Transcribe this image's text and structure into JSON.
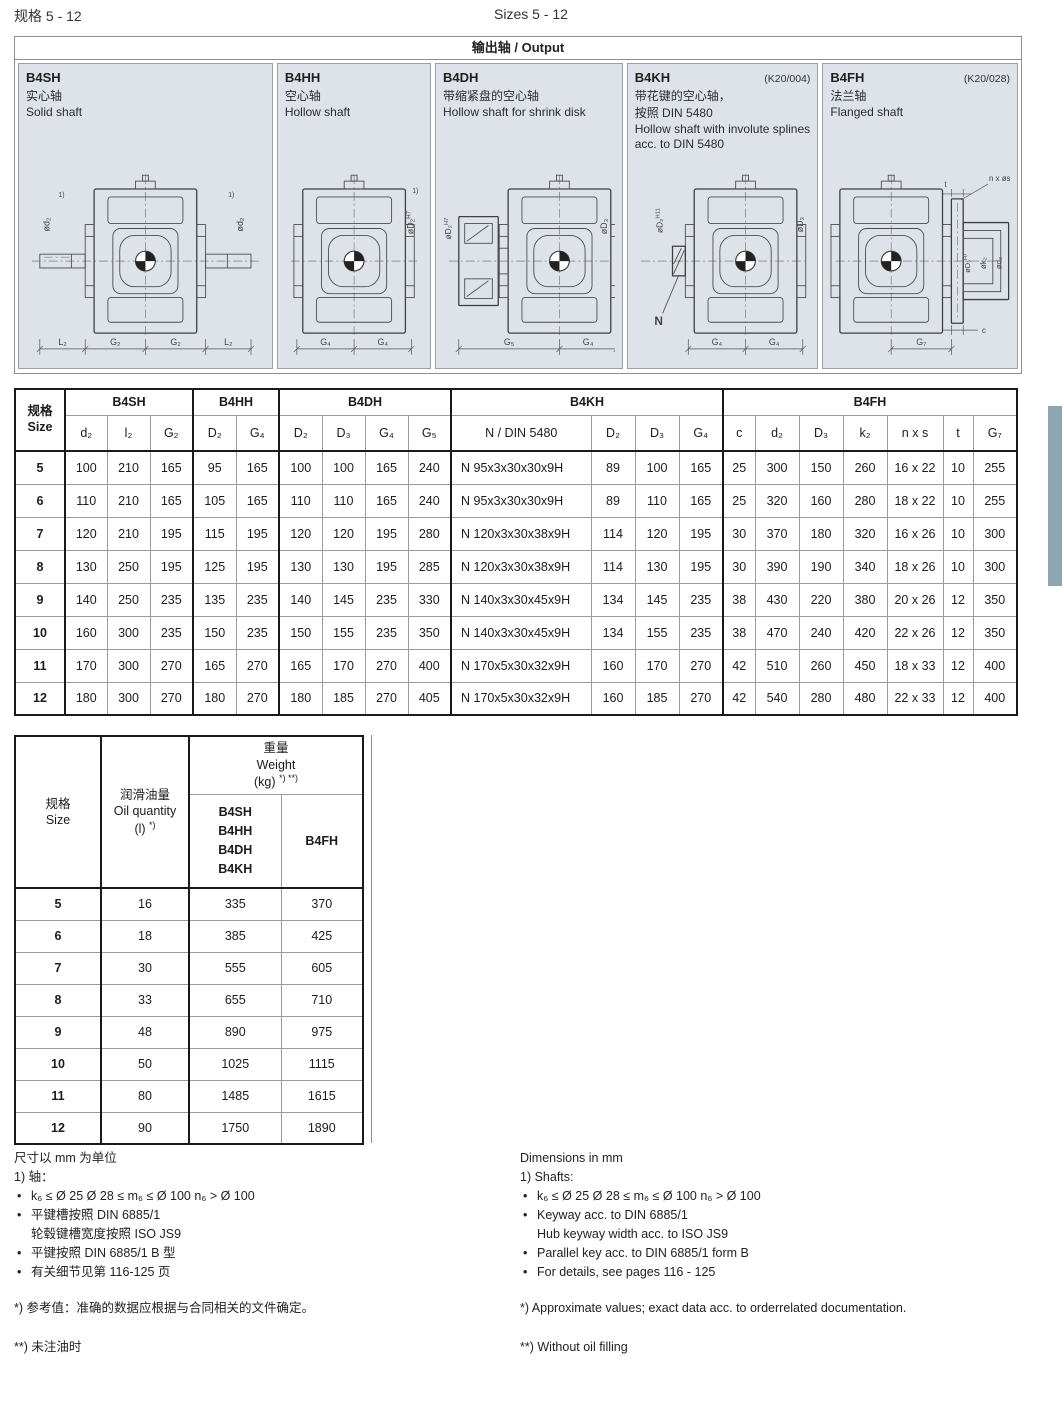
{
  "page": {
    "title_zh": "规格 5 - 12",
    "title_en": "Sizes 5 - 12"
  },
  "output_box": {
    "header": "输出轴 / Output",
    "panels": [
      {
        "code": "B4SH",
        "code_suffix": "",
        "name_zh": "实心轴",
        "name_en": "Solid shaft",
        "diagram": {
          "variant": "solid",
          "left_label": "ød₂",
          "right_label": "ød₂",
          "ref": "1)",
          "dims": [
            "L₂",
            "G₂",
            "G₂",
            "L₂"
          ]
        }
      },
      {
        "code": "B4HH",
        "code_suffix": "",
        "name_zh": "空心轴",
        "name_en": "Hollow shaft",
        "diagram": {
          "variant": "hollow",
          "right_label": "øD₂|H7",
          "ref": "1)",
          "dims": [
            "G₄",
            "G₄"
          ]
        }
      },
      {
        "code": "B4DH",
        "code_suffix": "",
        "name_zh": "带缩紧盘的空心轴",
        "name_en": "Hollow shaft for shrink disk",
        "diagram": {
          "variant": "shrink",
          "left_label": "øD₂|H7",
          "right_label": "øD₃",
          "dims": [
            "G₅",
            "G₄"
          ]
        }
      },
      {
        "code": "B4KH",
        "code_suffix": "(K20/004)",
        "name_zh": "带花键的空心轴，\n按照 DIN 5480",
        "name_en": "Hollow shaft with involute splines acc. to DIN 5480",
        "diagram": {
          "variant": "spline",
          "left_label": "øD₂|H11",
          "right_label": "øD₃",
          "leader_label": "N",
          "dims": [
            "G₄",
            "G₄"
          ]
        }
      },
      {
        "code": "B4FH",
        "code_suffix": "(K20/028)",
        "name_zh": "法兰轴",
        "name_en": "Flanged shaft",
        "diagram": {
          "variant": "flange",
          "top_label": "t",
          "bolt_label": "n x øs",
          "flange_labels": [
            "øD₃|H7",
            "øk₂",
            "ød₂"
          ],
          "c_label": "c",
          "dims": [
            "G₇"
          ]
        }
      }
    ]
  },
  "main_table": {
    "size_label_zh": "规格",
    "size_label_en": "Size",
    "groups": [
      {
        "name": "B4SH",
        "cols": [
          "d₂",
          "l₂",
          "G₂"
        ]
      },
      {
        "name": "B4HH",
        "cols": [
          "D₂",
          "G₄"
        ]
      },
      {
        "name": "B4DH",
        "cols": [
          "D₂",
          "D₃",
          "G₄",
          "G₅"
        ]
      },
      {
        "name": "B4KH",
        "cols": [
          "N / DIN 5480",
          "D₂",
          "D₃",
          "G₄"
        ]
      },
      {
        "name": "B4FH",
        "cols": [
          "c",
          "d₂",
          "D₃",
          "k₂",
          "n x s",
          "t",
          "G₇"
        ]
      }
    ],
    "rows": [
      {
        "size": "5",
        "values": [
          "100",
          "210",
          "165",
          "95",
          "165",
          "100",
          "100",
          "165",
          "240",
          "N 95x3x30x30x9H",
          "89",
          "100",
          "165",
          "25",
          "300",
          "150",
          "260",
          "16 x 22",
          "10",
          "255"
        ]
      },
      {
        "size": "6",
        "values": [
          "110",
          "210",
          "165",
          "105",
          "165",
          "110",
          "110",
          "165",
          "240",
          "N 95x3x30x30x9H",
          "89",
          "110",
          "165",
          "25",
          "320",
          "160",
          "280",
          "18 x 22",
          "10",
          "255"
        ]
      },
      {
        "size": "7",
        "values": [
          "120",
          "210",
          "195",
          "115",
          "195",
          "120",
          "120",
          "195",
          "280",
          "N 120x3x30x38x9H",
          "114",
          "120",
          "195",
          "30",
          "370",
          "180",
          "320",
          "16 x 26",
          "10",
          "300"
        ]
      },
      {
        "size": "8",
        "values": [
          "130",
          "250",
          "195",
          "125",
          "195",
          "130",
          "130",
          "195",
          "285",
          "N 120x3x30x38x9H",
          "114",
          "130",
          "195",
          "30",
          "390",
          "190",
          "340",
          "18 x 26",
          "10",
          "300"
        ]
      },
      {
        "size": "9",
        "values": [
          "140",
          "250",
          "235",
          "135",
          "235",
          "140",
          "145",
          "235",
          "330",
          "N 140x3x30x45x9H",
          "134",
          "145",
          "235",
          "38",
          "430",
          "220",
          "380",
          "20 x 26",
          "12",
          "350"
        ]
      },
      {
        "size": "10",
        "values": [
          "160",
          "300",
          "235",
          "150",
          "235",
          "150",
          "155",
          "235",
          "350",
          "N 140x3x30x45x9H",
          "134",
          "155",
          "235",
          "38",
          "470",
          "240",
          "420",
          "22 x 26",
          "12",
          "350"
        ]
      },
      {
        "size": "11",
        "values": [
          "170",
          "300",
          "270",
          "165",
          "270",
          "165",
          "170",
          "270",
          "400",
          "N 170x5x30x32x9H",
          "160",
          "170",
          "270",
          "42",
          "510",
          "260",
          "450",
          "18 x 33",
          "12",
          "400"
        ]
      },
      {
        "size": "12",
        "values": [
          "180",
          "300",
          "270",
          "180",
          "270",
          "180",
          "185",
          "270",
          "405",
          "N 170x5x30x32x9H",
          "160",
          "185",
          "270",
          "42",
          "540",
          "280",
          "480",
          "22 x 33",
          "12",
          "400"
        ]
      }
    ]
  },
  "weight_table": {
    "size_zh": "规格",
    "size_en": "Size",
    "oil_zh": "润滑油量",
    "oil_en": "Oil quantity",
    "oil_unit": "(l)",
    "oil_sup": "*)",
    "weight_zh": "重量",
    "weight_en": "Weight",
    "weight_unit": "(kg)",
    "weight_sup": "*) **)",
    "col1": "B4SH\nB4HH\nB4DH\nB4KH",
    "col2": "B4FH",
    "rows": [
      [
        "5",
        "16",
        "335",
        "370"
      ],
      [
        "6",
        "18",
        "385",
        "425"
      ],
      [
        "7",
        "30",
        "555",
        "605"
      ],
      [
        "8",
        "33",
        "655",
        "710"
      ],
      [
        "9",
        "48",
        "890",
        "975"
      ],
      [
        "10",
        "50",
        "1025",
        "1115"
      ],
      [
        "11",
        "80",
        "1485",
        "1615"
      ],
      [
        "12",
        "90",
        "1750",
        "1890"
      ]
    ]
  },
  "notes_zh": {
    "dim": "尺寸以 mm 为单位",
    "shaft_head": "1) 轴：",
    "bullets": [
      "k₆ ≤ Ø 25      Ø 28 ≤ m₆ ≤ Ø 100      n₆ > Ø 100",
      "平键槽按照 DIN 6885/1\n轮毂键槽宽度按照 ISO JS9",
      "平键按照 DIN 6885/1 B 型",
      "有关细节见第 116-125 页"
    ],
    "star": "*) 参考值：准确的数据应根据与合同相关的文件确定。",
    "dstar": "**) 未注油时"
  },
  "notes_en": {
    "dim": "Dimensions in mm",
    "shaft_head": "1) Shafts:",
    "bullets": [
      "k₆ ≤ Ø 25      Ø 28 ≤ m₆ ≤ Ø 100      n₆ > Ø 100",
      "Keyway acc. to DIN 6885/1\nHub keyway width acc. to ISO JS9",
      "Parallel key acc. to DIN 6885/1 form B",
      "For details, see pages 116 - 125"
    ],
    "star": "*) Approximate values; exact data acc. to orderrelated documentation.",
    "dstar": "**) Without oil filling"
  },
  "side_tab_color": "#8ea6b2"
}
